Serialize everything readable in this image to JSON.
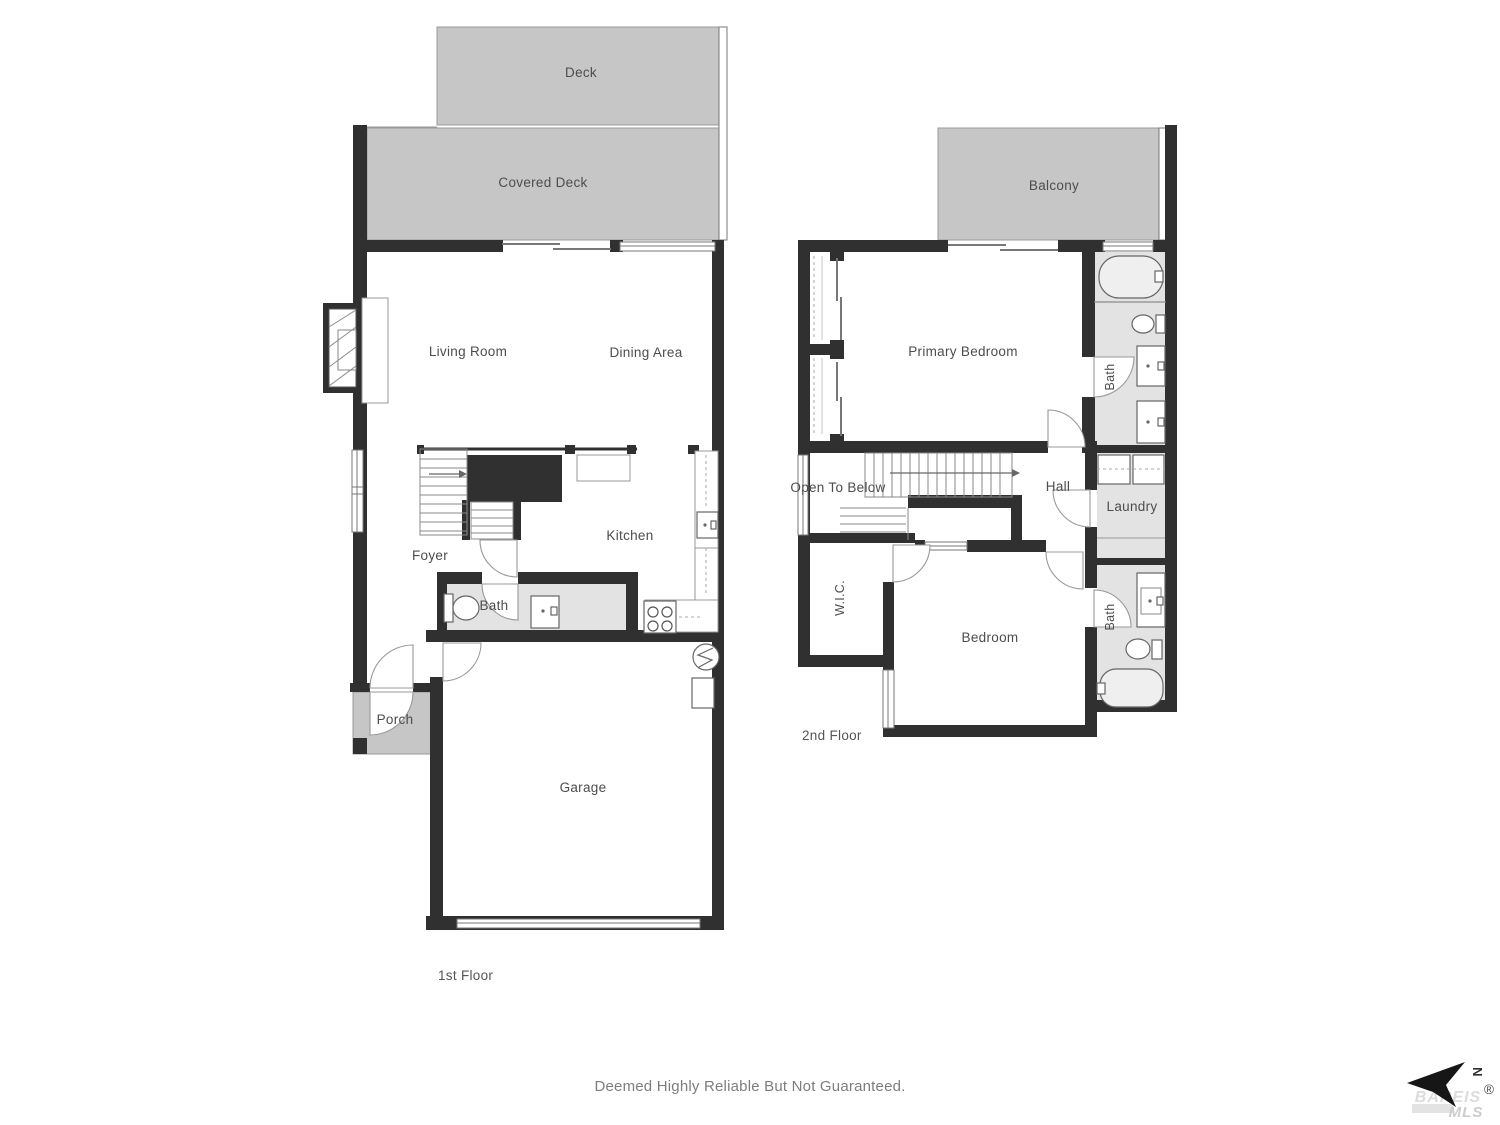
{
  "floor_plan": {
    "first_floor": {
      "name": "1st Floor",
      "rooms": {
        "deck": "Deck",
        "covered_deck": "Covered Deck",
        "living_room": "Living Room",
        "dining_area": "Dining Area",
        "foyer": "Foyer",
        "kitchen": "Kitchen",
        "bath": "Bath",
        "porch": "Porch",
        "garage": "Garage"
      }
    },
    "second_floor": {
      "name": "2nd Floor",
      "rooms": {
        "balcony": "Balcony",
        "primary_bedroom": "Primary Bedroom",
        "bath": "Bath",
        "open_to_below": "Open To Below",
        "hall": "Hall",
        "laundry": "Laundry",
        "wic": "W.I.C.",
        "bedroom": "Bedroom",
        "bath2": "Bath"
      }
    }
  },
  "footer": {
    "disclaimer": "Deemed Highly Reliable But Not Guaranteed."
  },
  "logo": {
    "compass": "N",
    "brand": "BAREIS",
    "registered": "®",
    "sub": "MLS"
  },
  "colors": {
    "wall": "#303030",
    "deck_gray": "#c6c6c6",
    "fixture_floor_gray": "#e3e3e3",
    "label_text": "#4d4d4d"
  }
}
